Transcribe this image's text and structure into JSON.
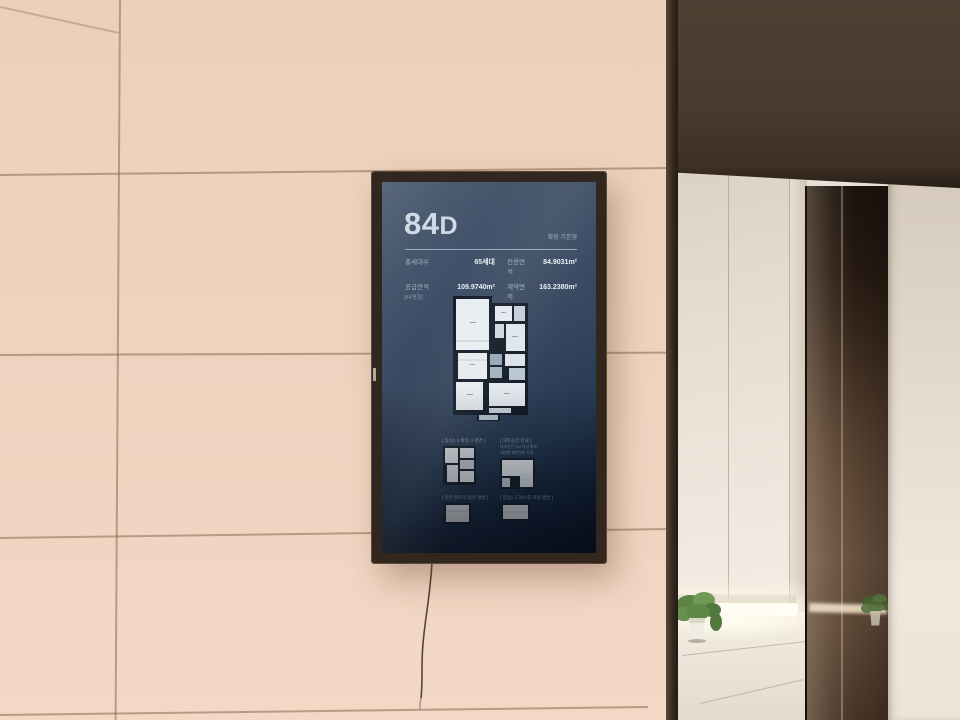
{
  "scene": {
    "wall_color": "#eed3bf",
    "soffit_color": "#46382c",
    "trim_color": "#352a20",
    "mirror_color": "#57422f",
    "led_glow_color": "#fff6e6",
    "plant_green": "#5d8347"
  },
  "kiosk": {
    "title_main": "84",
    "title_suffix": "D",
    "type_label": "확장 기본형",
    "stats": [
      {
        "label": "총세대수",
        "value": "65세대"
      },
      {
        "label": "전용면적",
        "value": "84.9031m²"
      },
      {
        "label": "공급면적",
        "value": "109.9740m²"
      },
      {
        "label": "계약면적",
        "value": "163.2380m²"
      }
    ],
    "plan_section_label": "[84평형]",
    "mini_plans": [
      {
        "caption": "[ 침실2·3 확장시 평면 ]"
      },
      {
        "caption": "[ 대피공간 안내 ]",
        "notes": [
          "대피공간 2㎡ 이상 확보",
          "세대별 제연설비 적용"
        ]
      },
      {
        "caption": "[ 현관 팬트리 옵션 평면 ]"
      },
      {
        "caption": "[ 침실1 드레스룸·욕실 평면 ]"
      }
    ],
    "screen_bg": "#3a4a60",
    "text_color": "#d3dde6"
  }
}
